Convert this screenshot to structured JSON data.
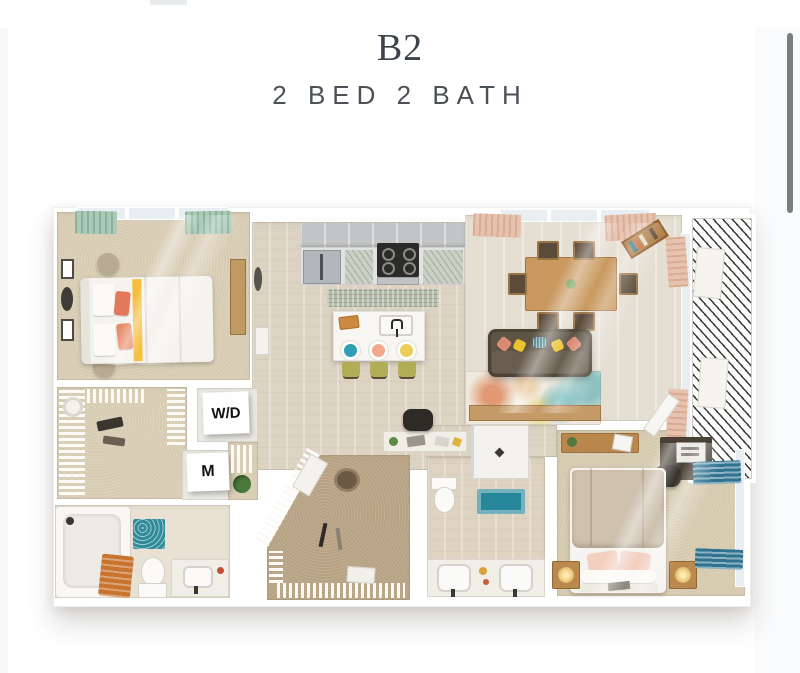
{
  "page": {
    "title": "B2",
    "subtitle": "2 BED 2 BATH"
  },
  "floorplan": {
    "labels": {
      "washer_dryer": "W/D",
      "mechanical": "M"
    },
    "palette": {
      "wall_white": "#ffffff",
      "wood_floor": "#dcd3c3",
      "living_floor": "#e5dfd3",
      "bedroom_carpet": "#d7cbb2",
      "closet_carpet": "#b7a283",
      "cabinet_gray": "#c6c8ca",
      "teal_curtain": "#a9cab7",
      "pink_curtain": "#e7c2ae",
      "blue_curtain": "#2f7390",
      "sofa_brown": "#5e5446",
      "accent_coral": "#e2795a",
      "accent_yellow": "#ecc22f",
      "accent_teal": "#2f9fb5",
      "stool_green": "#b1ae57",
      "wood_furniture": "#c9995f",
      "bath_mat_teal": "#27879a",
      "title_color": "#3d434b",
      "scrollbar_color": "#7b7d80"
    }
  }
}
